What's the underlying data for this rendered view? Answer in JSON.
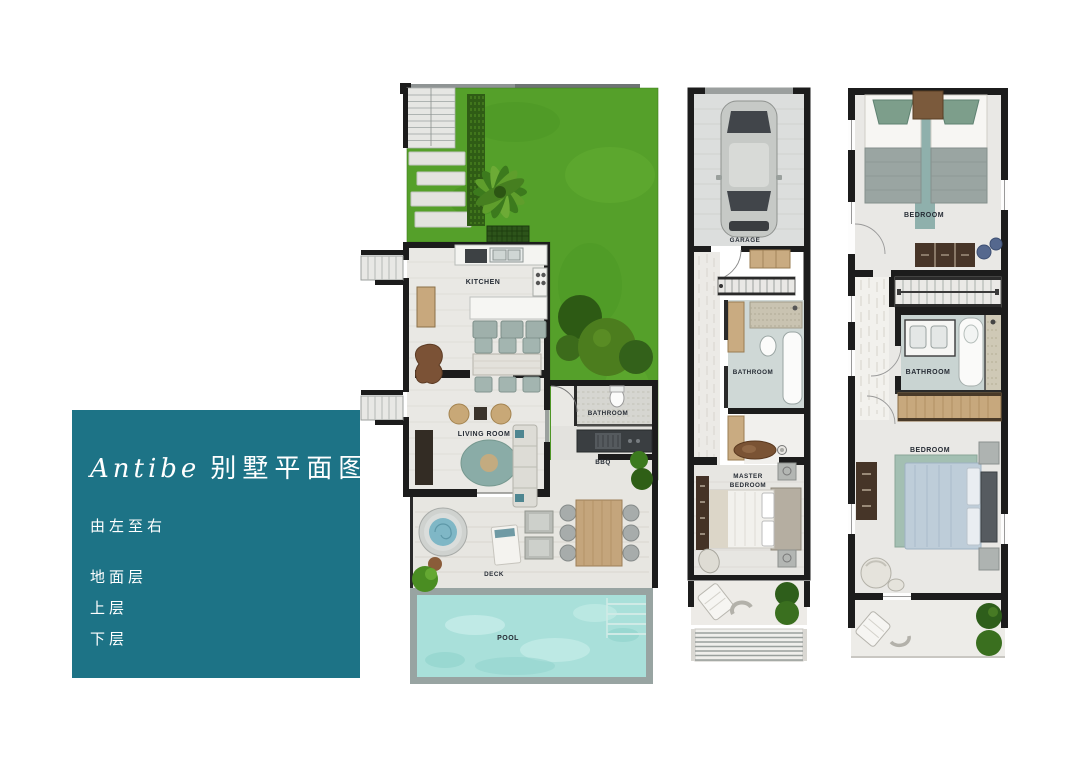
{
  "info_panel": {
    "title_latin": "Antibe",
    "title_cjk": "别墅平面图",
    "direction_note": "由左至右",
    "floor_items": [
      {
        "label": "地面层"
      },
      {
        "label": "上层"
      },
      {
        "label": "下层"
      }
    ]
  },
  "floor_plans": {
    "ground_floor": {
      "labels": {
        "kitchen": "KITCHEN",
        "living_room": "LIVING ROOM",
        "bathroom": "BATHROOM",
        "bbq": "BBQ",
        "deck": "DECK",
        "pool": "POOL"
      }
    },
    "upper_floor": {
      "labels": {
        "garage": "GARAGE",
        "bathroom": "BATHROOM",
        "master_line1": "MASTER",
        "master_line2": "BEDROOM"
      }
    },
    "lower_floor": {
      "labels": {
        "bedroom_top": "BEDROOM",
        "bathroom": "BATHROOM",
        "bedroom_bottom": "BEDROOM"
      }
    }
  },
  "colors": {
    "panel_teal": "#1d7386",
    "lawn_green": "#55a02a",
    "pool_water": "#a9e0da",
    "wall_black": "#1c1c1c"
  }
}
